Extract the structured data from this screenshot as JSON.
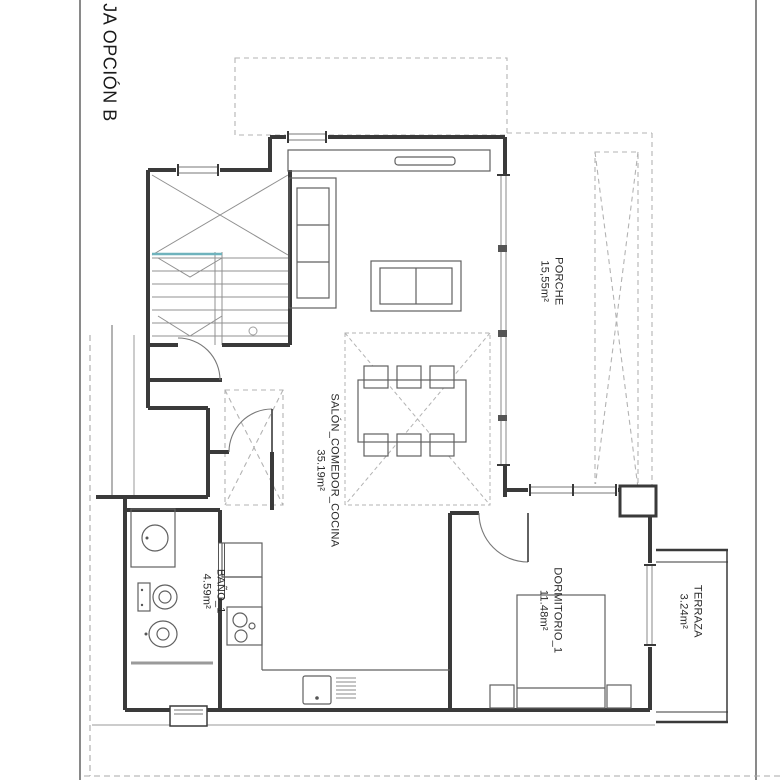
{
  "page": {
    "title": "JA OPCIÓN B",
    "colors": {
      "wall": "#3a3a3a",
      "thin_line": "#606060",
      "stair_line": "#909090",
      "dashed": "#b3b3b3",
      "accent_teal": "#6fb3bd"
    }
  },
  "rooms": {
    "porche": {
      "name": "PORCHE",
      "area": "15,55m²"
    },
    "salon": {
      "name": "SALÓN_COMEDOR_COCINA",
      "area": "35.19m²"
    },
    "dormitorio": {
      "name": "DORMITORIO_1",
      "area": "11.48m²"
    },
    "bano": {
      "name": "BAÑO_1",
      "area": "4.59m²"
    },
    "terraza": {
      "name": "TERRAZA",
      "area": "3.24m²"
    }
  }
}
